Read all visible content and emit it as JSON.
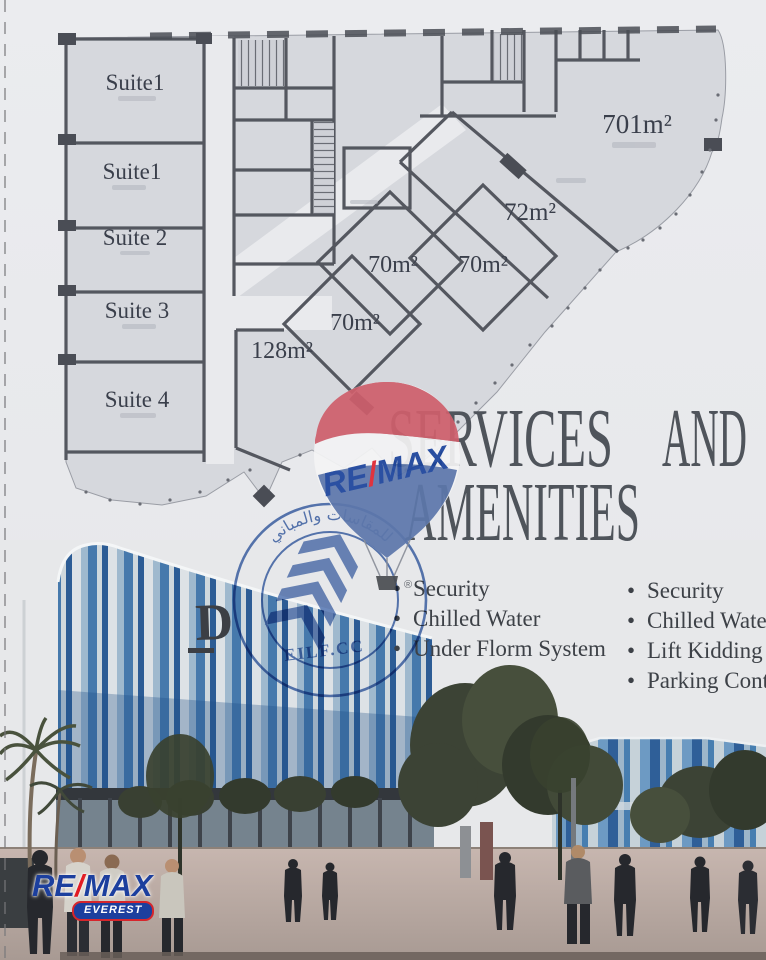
{
  "floor_plan": {
    "suites": [
      {
        "label": "Suite1"
      },
      {
        "label": "Suite1"
      },
      {
        "label": "Suite 2"
      },
      {
        "label": "Suite 3"
      },
      {
        "label": "Suite 4"
      }
    ],
    "areas": [
      {
        "label": "701m²"
      },
      {
        "label": "72m²"
      },
      {
        "label": "70m²"
      },
      {
        "label": "70m²"
      },
      {
        "label": "70m²"
      },
      {
        "label": "128m²"
      }
    ]
  },
  "heading": {
    "word1": "SERVICES",
    "word2": "AND",
    "line2": "AMENITIES"
  },
  "services_left": {
    "items": [
      "Security",
      "Chilled Water",
      "Under Florm System"
    ]
  },
  "services_right": {
    "items": [
      "Security",
      "Chilled Water",
      "Lift Kidding",
      "Parking Cont"
    ]
  },
  "balloon_logo": {
    "re": "RE",
    "slash": "/",
    "max": "MAX",
    "registered": "®"
  },
  "stamp": {
    "arabic_text": "للمقاسات والمباني",
    "company": "EILF.CC"
  },
  "footer_logo": {
    "re": "RE",
    "slash": "/",
    "max": "MAX",
    "sub": "EVEREST"
  },
  "colors": {
    "stamp_blue": "#3f66ad",
    "balloon_red": "#cf5f6c",
    "balloon_blue": "#5d77ab",
    "remax_blue": "#1c449c",
    "remax_red": "#e02430",
    "plan_fill": "#d6d8dd",
    "plan_wall": "#54575f",
    "heading_text": "#4f545b"
  }
}
